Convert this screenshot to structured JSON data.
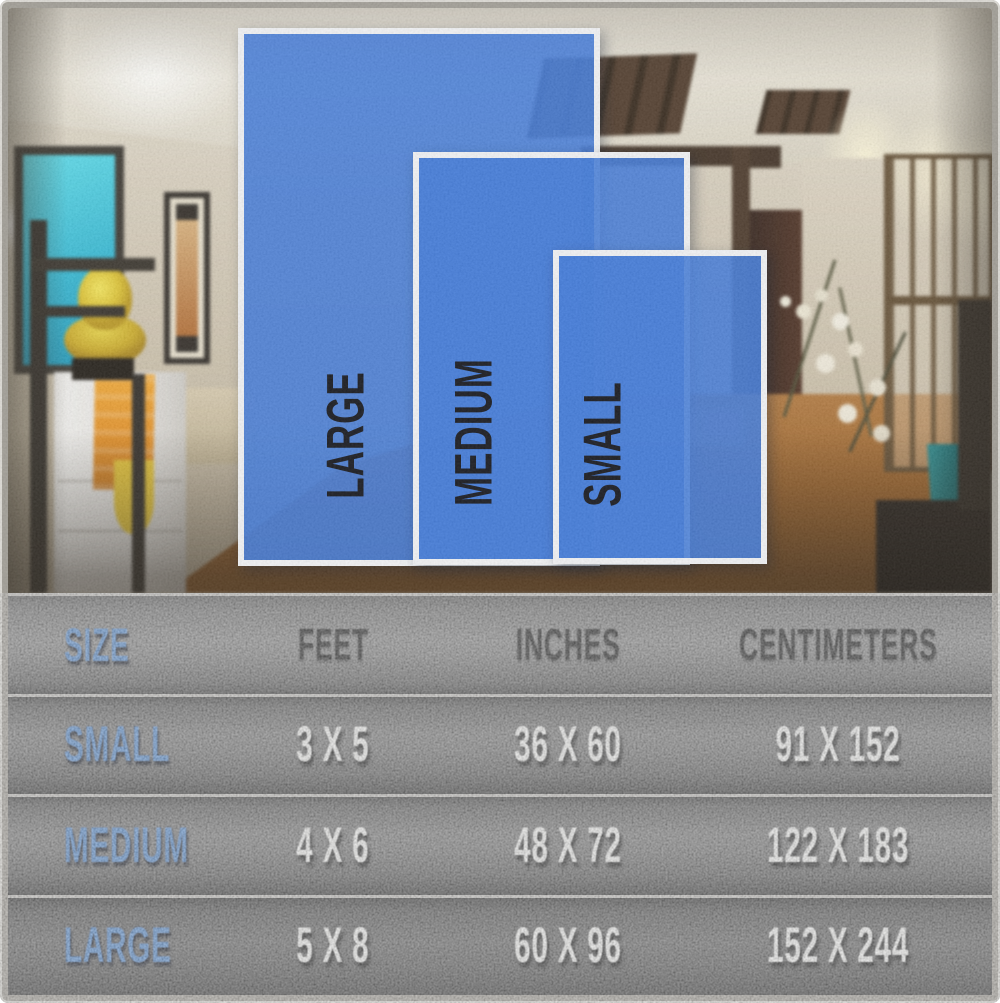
{
  "overlay": {
    "rugs": [
      {
        "id": "large",
        "label": "LARGE"
      },
      {
        "id": "medium",
        "label": "MEDIUM"
      },
      {
        "id": "small",
        "label": "SMALL"
      }
    ]
  },
  "table": {
    "headers": [
      "SIZE",
      "FEET",
      "INCHES",
      "CENTIMETERS"
    ],
    "rows": [
      {
        "size": "SMALL",
        "feet": "3 X 5",
        "inches": "36 X 60",
        "centimeters": "91 X 152"
      },
      {
        "size": "MEDIUM",
        "feet": "4 X 6",
        "inches": "48 X 72",
        "centimeters": "122 X 183"
      },
      {
        "size": "LARGE",
        "feet": "5 X 8",
        "inches": "60 X 96",
        "centimeters": "152 X 244"
      }
    ]
  },
  "colors": {
    "rug_blue": "#3a75d9",
    "rug_border_white": "#f2f4f6",
    "label_blue": "#4f86cb",
    "value_white": "#f1f1ef",
    "header_black": "#151515",
    "table_grey": "#6e6e6e"
  },
  "chart_data": {
    "type": "table",
    "columns": [
      "SIZE",
      "FEET",
      "INCHES",
      "CENTIMETERS"
    ],
    "rows": [
      [
        "SMALL",
        "3 X 5",
        "36 X 60",
        "91 X 152"
      ],
      [
        "MEDIUM",
        "4 X 6",
        "48 X 72",
        "122 X 183"
      ],
      [
        "LARGE",
        "5 X 8",
        "60 X 96",
        "152 X 244"
      ]
    ]
  }
}
